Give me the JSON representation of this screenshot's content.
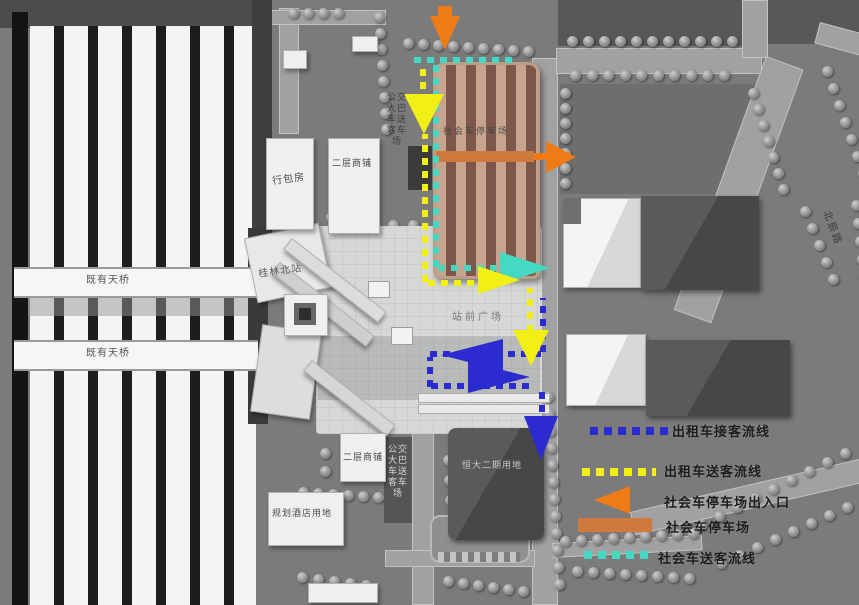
{
  "labels": {
    "existing_footbridge_upper": "既有天桥",
    "existing_footbridge_lower": "既有天桥",
    "luggage_hall": "行包房",
    "second_floor_shops_upper": "二层商铺",
    "guilin_north_station": "桂林北站",
    "station_front_plaza": "站前广场",
    "second_floor_shops_lower": "二层商铺",
    "bus_coach_dropoff_upper": "公交大巴车送客车场",
    "bus_coach_dropoff_lower": "公交大巴车送客车场",
    "hengda_phase2_site": "恒大二期用地",
    "planned_hotel_site": "规划酒店用地",
    "beichen_road": "北辰路",
    "social_parking_inline": "社会车停车场"
  },
  "legend": {
    "items": [
      {
        "id": "taxi-pickup-line",
        "label": "出租车接客流线",
        "color": "#2b2bd0",
        "swatch": "dashed-line"
      },
      {
        "id": "taxi-dropoff-line",
        "label": "出租车送客流线",
        "color": "#f2ef16",
        "swatch": "dashed-line"
      },
      {
        "id": "social-car-park-entrance",
        "label": "社会车停车场出入口",
        "color": "#ef7b17",
        "swatch": "arrow"
      },
      {
        "id": "social-car-park",
        "label": "社会车停车场",
        "color": "#d0793f",
        "swatch": "solid-bar"
      },
      {
        "id": "social-car-dropoff-line",
        "label": "社会车送客流线",
        "color": "#45d8c2",
        "swatch": "dashed-line"
      }
    ]
  },
  "colors": {
    "taxi_pickup_blue": "#2b2bd0",
    "taxi_dropoff_yellow": "#f2ef16",
    "social_dropoff_teal": "#45d8c2",
    "entrance_arrow_orange": "#ef7b17",
    "parking_band_orange": "#d0793f",
    "parking_structure_tan": "#c6a48d"
  }
}
